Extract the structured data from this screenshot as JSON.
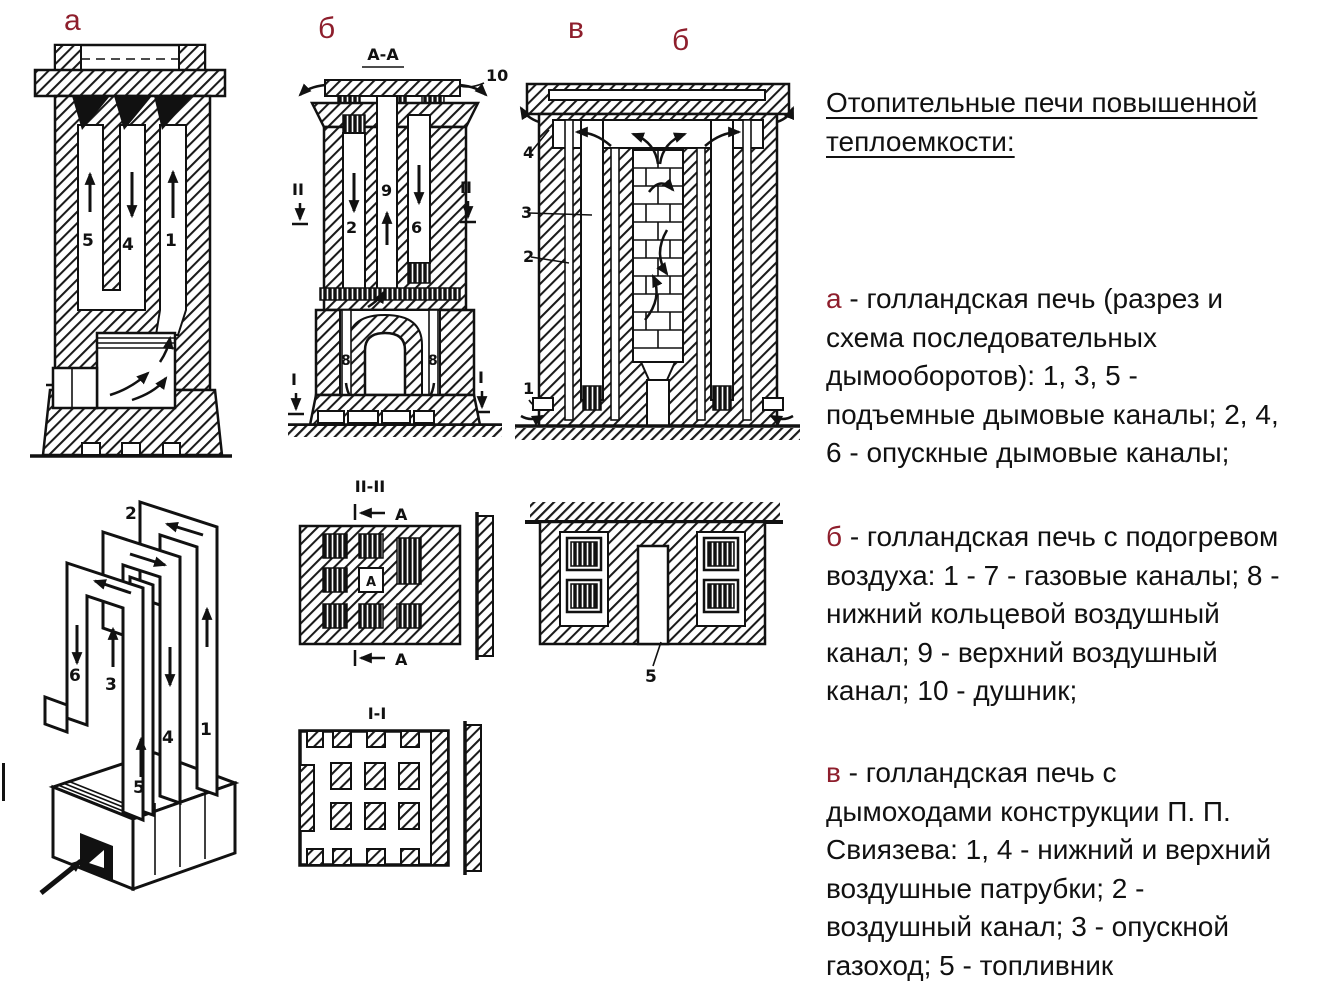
{
  "colors": {
    "accent_red": "#8e1e2c",
    "ink": "#111111",
    "paper": "#ffffff"
  },
  "figure_labels": {
    "a": "а",
    "b": "б",
    "v": "в",
    "b2": "б"
  },
  "diagram_a_section": {
    "channel_labels": [
      "5",
      "4",
      "1"
    ]
  },
  "diagram_a_scheme": {
    "channel_labels": [
      "6",
      "3",
      "5",
      "4",
      "1",
      "2"
    ]
  },
  "diagram_b_section": {
    "section_title": "А-А",
    "vent_callout": "10",
    "channel_labels": [
      "2",
      "9",
      "6"
    ],
    "air_ring_labels": [
      "8",
      "8"
    ],
    "cut_upper": "II",
    "cut_lower": "I"
  },
  "section_ii_plan": {
    "title": "II-II",
    "datum_label": "А",
    "center_cell_label": "А"
  },
  "section_i_plan": {
    "title": "I-I"
  },
  "diagram_v_section": {
    "callouts": [
      "4",
      "3",
      "2",
      "1"
    ]
  },
  "diagram_v_plan": {
    "firebox_callout": "5"
  },
  "text_panel": {
    "title": "Отопительные печи повышенной\nтеплоемкости:",
    "paragraphs": [
      {
        "letter": "а",
        "body": " - голландская печь (разрез и\nсхема последовательных\nдымооборотов): 1, 3, 5 -\nподъемные дымовые каналы; 2, 4,\n6 - опускные дымовые каналы;"
      },
      {
        "letter": "б",
        "body": " - голландская печь с подогревом\nвоздуха: 1 - 7 - газовые каналы; 8 -\nнижний кольцевой воздушный\nканал; 9 - верхний воздушный\nканал; 10 - душник;"
      },
      {
        "letter": "в",
        "body": " - голландская печь с\nдымоходами конструкции П. П.\nСвиязева: 1, 4 - нижний и верхний\nвоздушные патрубки; 2 -\nвоздушный канал; 3 - опускной\nгазоход; 5 - топливник"
      }
    ]
  }
}
